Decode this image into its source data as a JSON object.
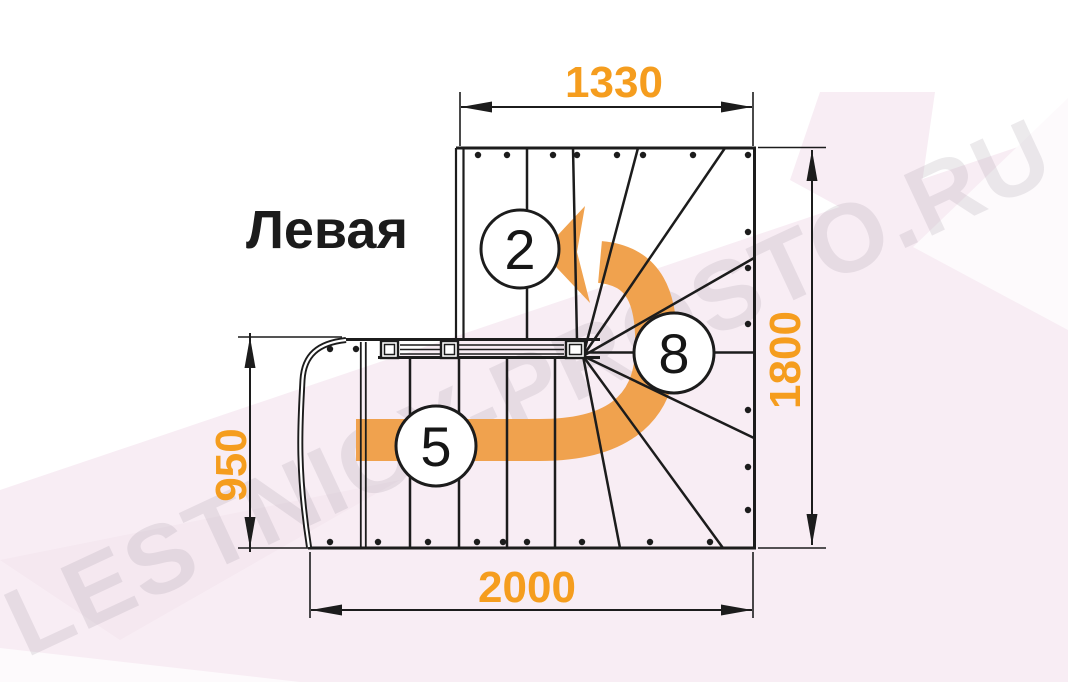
{
  "watermark": {
    "text": "LESTNICY-PROSTO.RU"
  },
  "title": {
    "text": "Левая"
  },
  "dimensions": {
    "top": "1330",
    "right": "1800",
    "left": "950",
    "bottom": "2000"
  },
  "step_labels": {
    "upper_flight": "2",
    "lower_flight": "5",
    "winder": "8"
  },
  "colors": {
    "dimension_text": "#F59D1E",
    "direction_arrow": "#F0A24E",
    "drawing_line": "#1C1C1C",
    "background_tint": "#F8EDF4",
    "watermark": "#8C8290"
  }
}
